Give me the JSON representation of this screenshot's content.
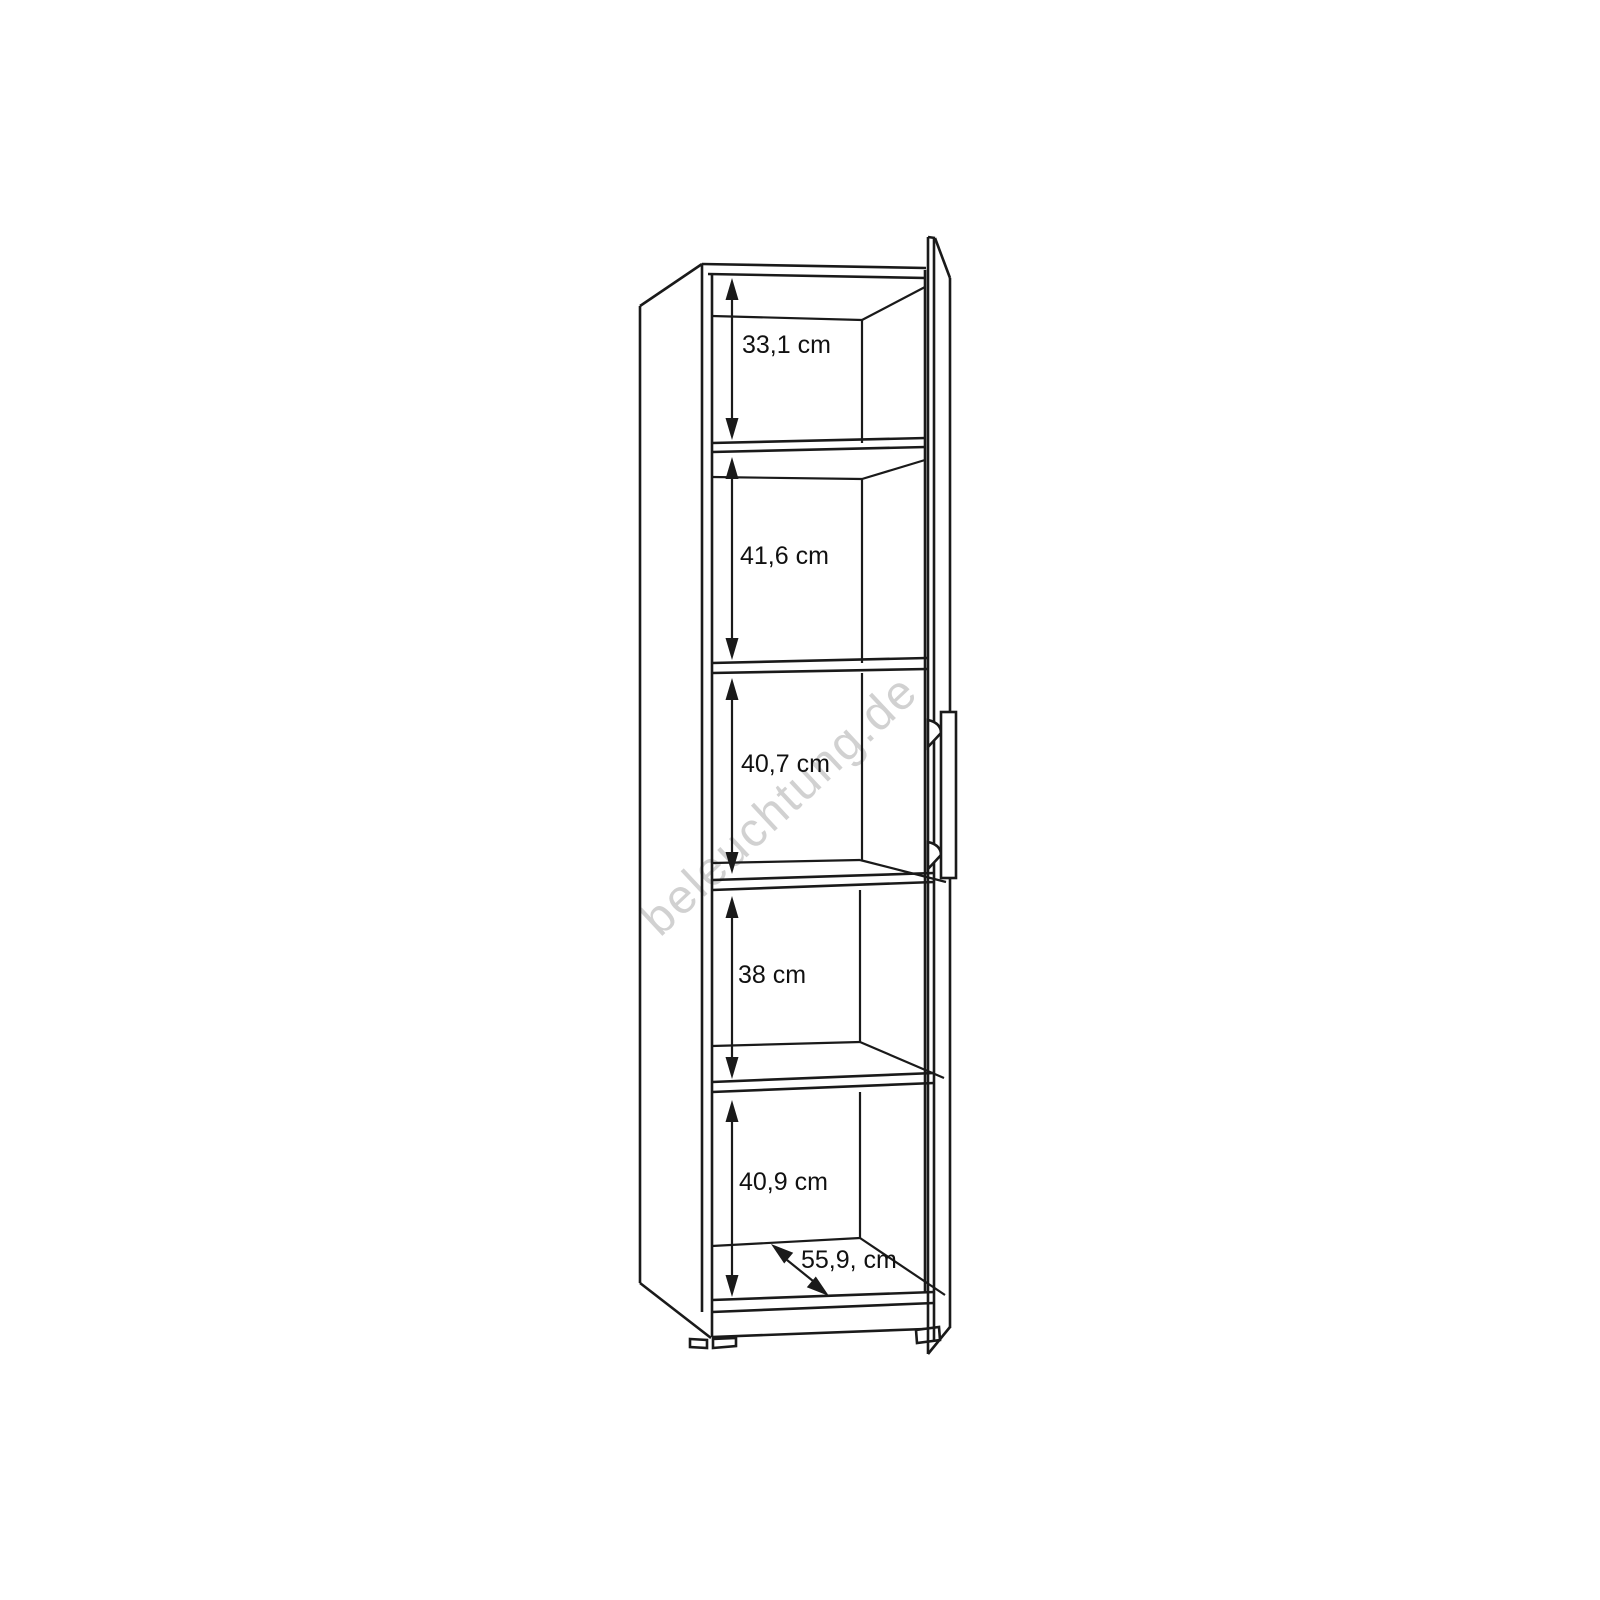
{
  "diagram": {
    "watermark": "beleuchtung.de",
    "unit_note": "cm",
    "dimensions": [
      {
        "name": "compartment-1-height",
        "label": "33,1 cm"
      },
      {
        "name": "compartment-2-height",
        "label": "41,6 cm"
      },
      {
        "name": "compartment-3-height",
        "label": "40,7 cm"
      },
      {
        "name": "compartment-4-height",
        "label": "38 cm"
      },
      {
        "name": "compartment-5-height",
        "label": "40,9 cm"
      },
      {
        "name": "interior-depth",
        "label": "55,9, cm"
      }
    ]
  }
}
